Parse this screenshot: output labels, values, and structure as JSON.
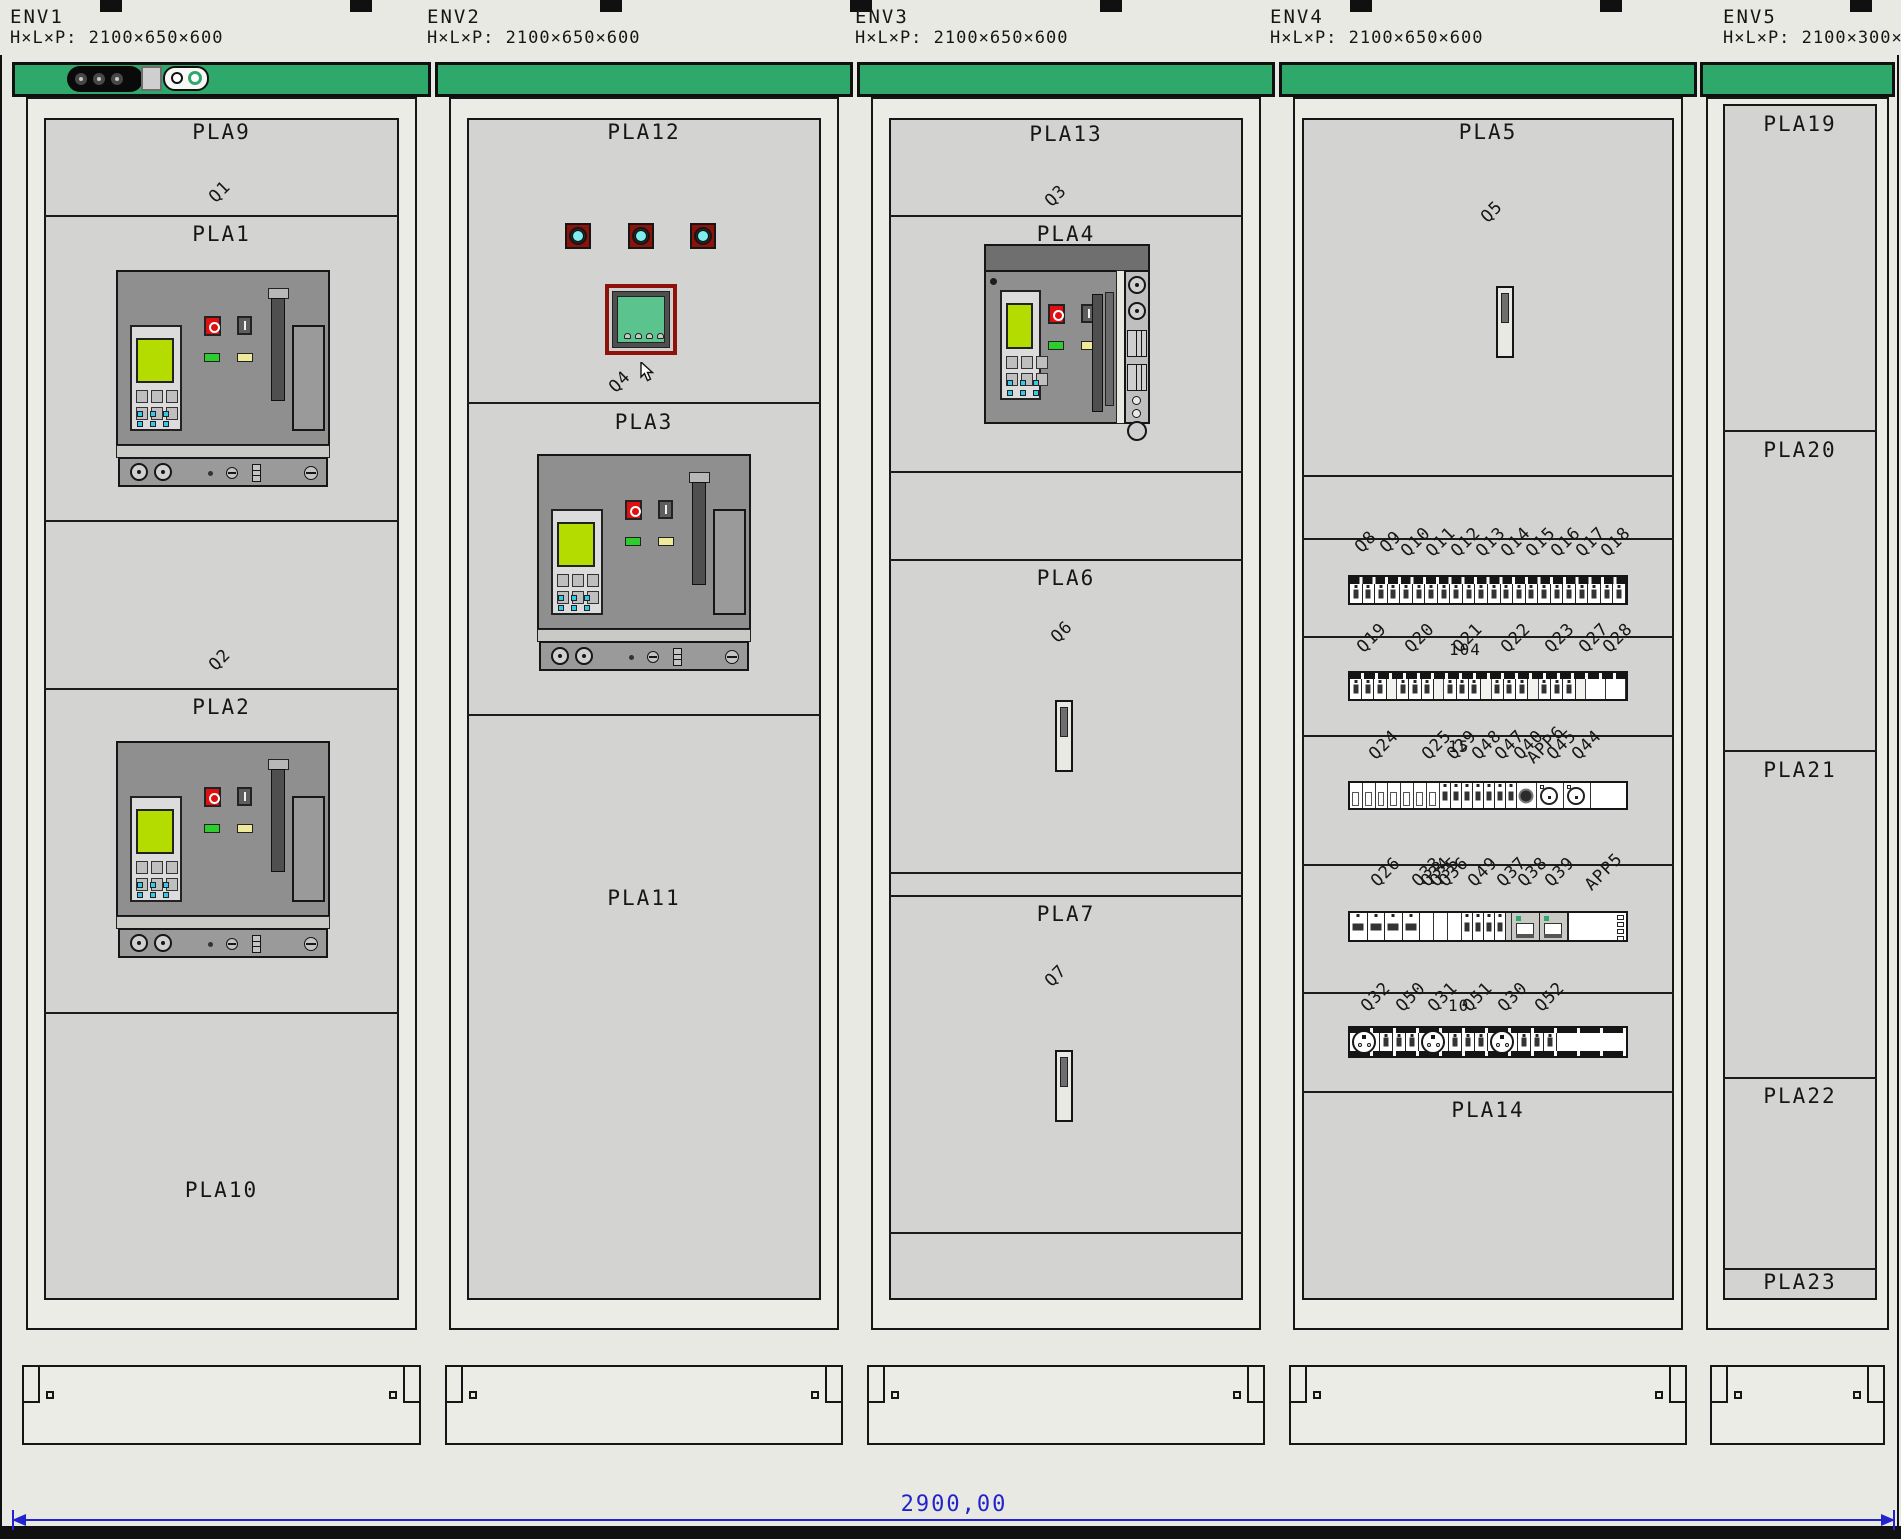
{
  "enclosures": [
    {
      "name": "ENV1",
      "dims": "H×L×P: 2100×650×600",
      "sections": [
        {
          "label": "PLA9"
        },
        {
          "label": "PLA1"
        },
        {
          "label": "PLA2"
        },
        {
          "label": "PLA10"
        }
      ],
      "device_tags": [
        "Q1",
        "Q2"
      ]
    },
    {
      "name": "ENV2",
      "dims": "H×L×P: 2100×650×600",
      "sections": [
        {
          "label": "PLA12"
        },
        {
          "label": "PLA3"
        },
        {
          "label": "PLA11"
        }
      ],
      "device_tags": [
        "Q4"
      ]
    },
    {
      "name": "ENV3",
      "dims": "H×L×P: 2100×650×600",
      "sections": [
        {
          "label": "PLA13"
        },
        {
          "label": "PLA4"
        },
        {
          "label": "PLA6"
        },
        {
          "label": "PLA7"
        }
      ],
      "device_tags": [
        "Q3",
        "Q6",
        "Q7"
      ]
    },
    {
      "name": "ENV4",
      "dims": "H×L×P: 2100×650×600",
      "sections": [
        {
          "label": "PLA5"
        },
        {
          "label": "PLA14"
        }
      ],
      "device_tags": [
        "Q5"
      ],
      "breaker_rows": [
        {
          "tags": [
            "Q8",
            "Q9",
            "Q10",
            "Q11",
            "Q12",
            "Q13",
            "Q14",
            "Q15",
            "Q16",
            "Q17",
            "Q18"
          ],
          "note": ""
        },
        {
          "tags": [
            "Q19",
            "Q20",
            "Q21",
            "Q22",
            "Q23",
            "Q27",
            "Q28"
          ],
          "note": "104"
        },
        {
          "tags": [
            "Q24",
            "Q25",
            "Q29",
            "Q48",
            "Q47",
            "Q40",
            "APP6",
            "Q45",
            "Q44"
          ],
          "note": "15"
        },
        {
          "tags": [
            "Q26",
            "Q33",
            "Q34",
            "Q35",
            "Q36",
            "Q49",
            "Q37",
            "Q38",
            "Q39",
            "APP5"
          ],
          "note": ""
        },
        {
          "tags": [
            "Q32",
            "Q50",
            "Q31",
            "Q51",
            "Q30",
            "Q52"
          ],
          "note": "10"
        }
      ]
    },
    {
      "name": "ENV5",
      "dims": "H×L×P: 2100×300×6",
      "sections": [
        {
          "label": "PLA19"
        },
        {
          "label": "PLA20"
        },
        {
          "label": "PLA21"
        },
        {
          "label": "PLA22"
        },
        {
          "label": "PLA23"
        }
      ]
    }
  ],
  "dimension": {
    "total": "2900,00"
  },
  "colors": {
    "accent_green": "#2EA86B",
    "panel_gray": "#D3D3D1",
    "dimension_blue": "#2323CD",
    "breaker_gray": "#8F8F8F",
    "screen_green": "#B5DC00",
    "meter_screen_green": "#5BC48E",
    "indicator_cyan": "#80EEEE",
    "bezel_maroon": "#8E120A",
    "led_green": "#2ECC2E",
    "led_yellow": "#EFEA9A",
    "stop_red": "#E01010"
  }
}
